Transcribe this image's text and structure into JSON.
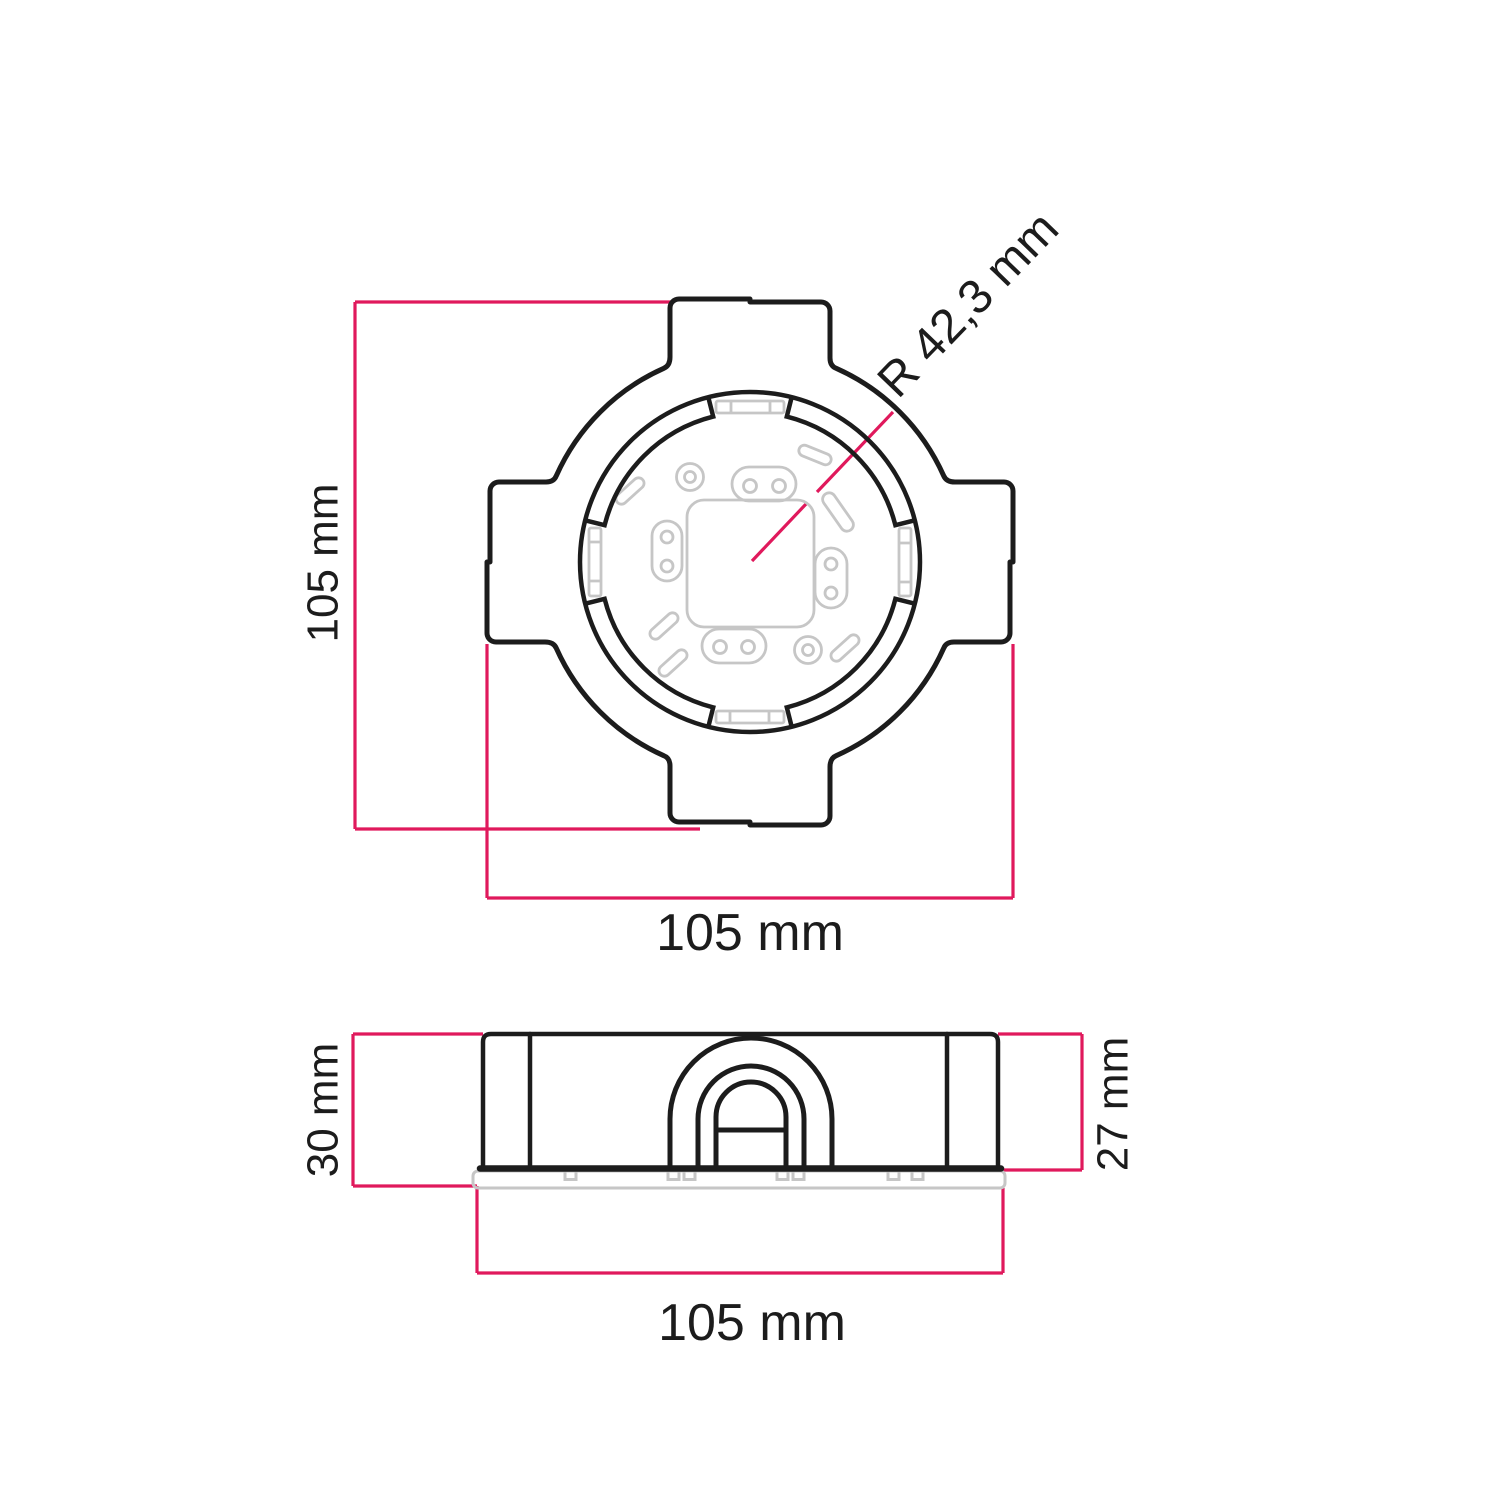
{
  "colors": {
    "outline": "#1c1c1c",
    "detail": "#c6c6c6",
    "dimension": "#e0195c",
    "label": "#1c1c1c",
    "background": "#ffffff"
  },
  "top_view": {
    "height_label": "105 mm",
    "width_label": "105 mm",
    "radius_label": "R 42,3 mm"
  },
  "side_view": {
    "left_height_label": "30 mm",
    "right_height_label": "27 mm",
    "width_label": "105 mm"
  }
}
